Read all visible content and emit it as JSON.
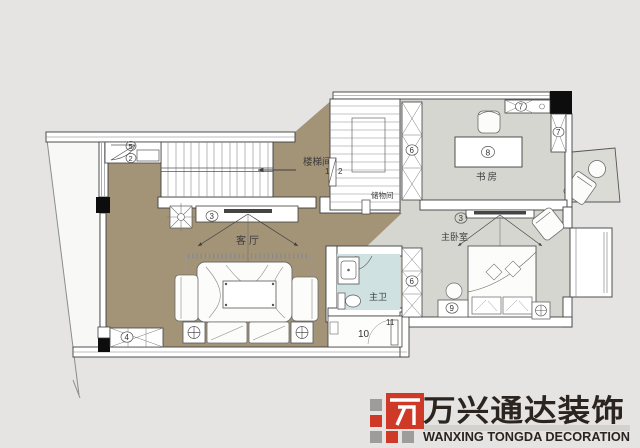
{
  "colors": {
    "page_bg": "#e5e4e3",
    "living_floor": "#a39377",
    "wing_floor": "#d5d6cf",
    "bath_floor": "#cfe2e1",
    "balcony_floor": "#dadbd4",
    "terrace": "#f8f8f6",
    "wall_fill": "#ffffff",
    "line": "#3f3f3f",
    "column_black": "#0d0d0d"
  },
  "labels": {
    "stairwell": "楼梯间",
    "storage": "储物间",
    "study": "书房",
    "living": "客厅",
    "master_bedroom": "主卧室",
    "master_bath": "主卫"
  },
  "markers": {
    "entry_door": "5",
    "entry_cabinet": "2",
    "stair_left": "1",
    "stair_right": "2",
    "living_tv": "3",
    "living_cabinet": "4",
    "study_wardrobe": "6",
    "bedroom_wardrobe": "6",
    "top_cabinet": "7",
    "side_cabinet": "7",
    "desk": "8",
    "bedroom_tv": "3",
    "dresser": "9",
    "utility_room": "10",
    "utility_door": "11"
  },
  "logo": {
    "title_cn": "万兴通达装饰",
    "title_en": "WANXING TONGDA DECORATION",
    "red": "#cf3a28",
    "gray": "#9c9c9c",
    "text_color": "#2c241f"
  }
}
